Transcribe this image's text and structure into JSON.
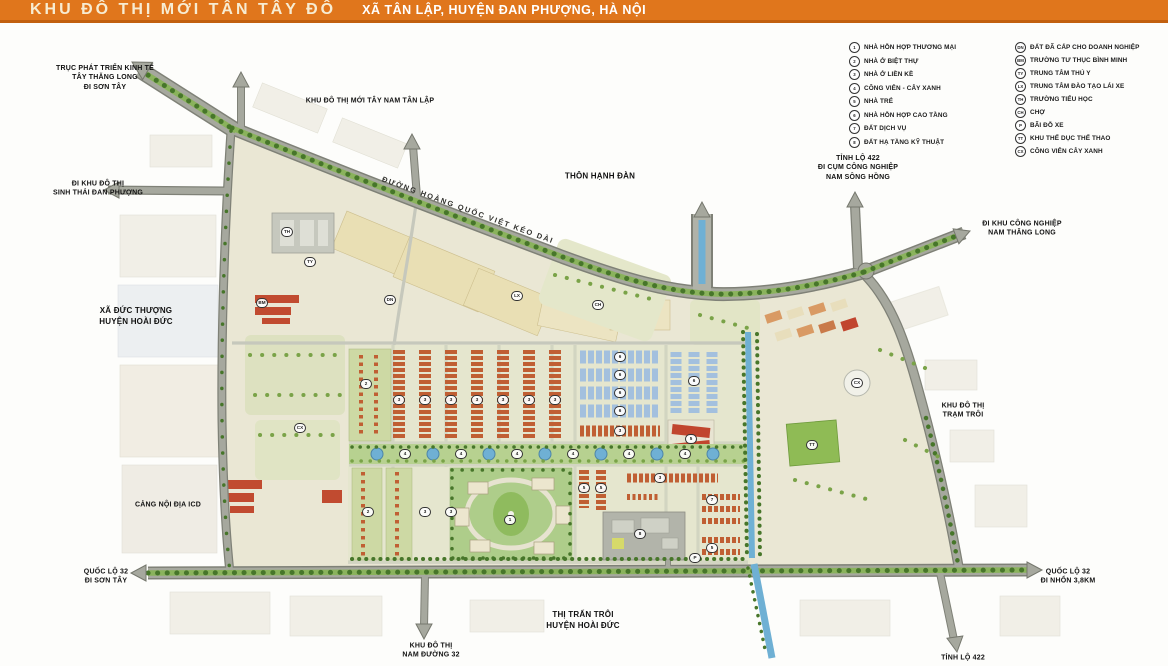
{
  "header": {
    "title": "KHU ĐÔ THỊ MỚI TÂN TÂY ĐÔ",
    "subtitle": "XÃ TÂN LẬP, HUYỆN ĐAN PHƯỢNG, HÀ NỘI"
  },
  "legend": {
    "numbered": [
      {
        "code": "1",
        "label": "NHÀ HỖN HỢP THƯƠNG MẠI"
      },
      {
        "code": "2",
        "label": "NHÀ Ở BIỆT THỰ"
      },
      {
        "code": "3",
        "label": "NHÀ Ở LIỀN KỀ"
      },
      {
        "code": "4",
        "label": "CÔNG VIÊN - CÂY XANH"
      },
      {
        "code": "5",
        "label": "NHÀ TRẺ"
      },
      {
        "code": "6",
        "label": "NHÀ HỖN HỢP CAO TẦNG"
      },
      {
        "code": "7",
        "label": "ĐẤT DỊCH VỤ"
      },
      {
        "code": "8",
        "label": "ĐẤT HẠ TẦNG KỸ THUẬT"
      }
    ],
    "lettered": [
      {
        "code": "DN",
        "label": "ĐẤT ĐÃ CẤP CHO DOANH NGHIỆP"
      },
      {
        "code": "BM",
        "label": "TRƯỜNG TƯ THỤC BÌNH MINH"
      },
      {
        "code": "TY",
        "label": "TRUNG TÂM THÚ Y"
      },
      {
        "code": "LX",
        "label": "TRUNG TÂM ĐÀO TẠO LÁI XE"
      },
      {
        "code": "TH",
        "label": "TRƯỜNG TIỂU HỌC"
      },
      {
        "code": "CH",
        "label": "CHỢ"
      },
      {
        "code": "P",
        "label": "BÃI ĐỖ XE"
      },
      {
        "code": "TT",
        "label": "KHU THỂ DỤC THỂ THAO"
      },
      {
        "code": "CX",
        "label": "CÔNG VIÊN CÂY XANH"
      }
    ]
  },
  "map_labels": {
    "economic_axis": "TRỤC PHÁT TRIỂN KINH TẾ\nTÂY THĂNG LONG\nĐI SƠN TÂY",
    "tay_nam_tan_lap": "KHU ĐÔ THỊ MỚI TÂY NAM TÂN LẬP",
    "sinh_thai_dan_phuong": "ĐI KHU ĐÔ THỊ\nSINH THÁI ĐAN PHƯỢNG",
    "thon_hanh_dan": "THÔN HẠNH ĐÀN",
    "hoang_quoc_viet": "ĐƯỜNG HOÀNG QUỐC VIỆT KÉO DÀI",
    "tl422_north": "TỈNH LỘ 422\nĐI CỤM CÔNG NGHIỆP\nNAM SÔNG HỒNG",
    "nam_thang_long": "ĐI KHU CÔNG NGHIỆP\nNAM THĂNG LONG",
    "xa_duc_thuong": "XÃ ĐỨC THƯỢNG\nHUYỆN HOÀI ĐỨC",
    "tram_troi": "KHU ĐÔ THỊ\nTRẠM TRÔI",
    "cang_icd": "CẢNG NỘI ĐỊA ICD",
    "ql32_west": "QUỐC LỘ 32\nĐI SƠN TÂY",
    "ql32_east": "QUỐC LỘ 32\nĐI NHỔN 3,8KM",
    "thi_tran_troi": "THỊ TRẤN TRÔI\nHUYỆN HOÀI ĐỨC",
    "nam_duong_32": "KHU ĐÔ THỊ\nNAM ĐƯỜNG 32",
    "tl422_south": "TỈNH LỘ 422"
  },
  "markers": [
    {
      "code": "2",
      "x": 366,
      "y": 384
    },
    {
      "code": "3",
      "x": 399,
      "y": 400
    },
    {
      "code": "3",
      "x": 425,
      "y": 400
    },
    {
      "code": "3",
      "x": 451,
      "y": 400
    },
    {
      "code": "3",
      "x": 477,
      "y": 400
    },
    {
      "code": "3",
      "x": 503,
      "y": 400
    },
    {
      "code": "3",
      "x": 529,
      "y": 400
    },
    {
      "code": "3",
      "x": 555,
      "y": 400
    },
    {
      "code": "6",
      "x": 620,
      "y": 357
    },
    {
      "code": "6",
      "x": 620,
      "y": 375
    },
    {
      "code": "6",
      "x": 620,
      "y": 393
    },
    {
      "code": "6",
      "x": 620,
      "y": 411
    },
    {
      "code": "6",
      "x": 694,
      "y": 381
    },
    {
      "code": "3",
      "x": 620,
      "y": 431
    },
    {
      "code": "5",
      "x": 691,
      "y": 439
    },
    {
      "code": "4",
      "x": 405,
      "y": 454
    },
    {
      "code": "4",
      "x": 461,
      "y": 454
    },
    {
      "code": "4",
      "x": 517,
      "y": 454
    },
    {
      "code": "4",
      "x": 573,
      "y": 454
    },
    {
      "code": "4",
      "x": 629,
      "y": 454
    },
    {
      "code": "4",
      "x": 685,
      "y": 454
    },
    {
      "code": "2",
      "x": 368,
      "y": 512
    },
    {
      "code": "3",
      "x": 425,
      "y": 512
    },
    {
      "code": "3",
      "x": 451,
      "y": 512
    },
    {
      "code": "1",
      "x": 510,
      "y": 520
    },
    {
      "code": "5",
      "x": 584,
      "y": 488
    },
    {
      "code": "5",
      "x": 601,
      "y": 488
    },
    {
      "code": "3",
      "x": 660,
      "y": 478
    },
    {
      "code": "8",
      "x": 640,
      "y": 534
    },
    {
      "code": "7",
      "x": 712,
      "y": 500
    },
    {
      "code": "5",
      "x": 712,
      "y": 548
    },
    {
      "code": "TH",
      "x": 287,
      "y": 232
    },
    {
      "code": "BM",
      "x": 262,
      "y": 303
    },
    {
      "code": "TY",
      "x": 310,
      "y": 262
    },
    {
      "code": "DN",
      "x": 390,
      "y": 300
    },
    {
      "code": "LX",
      "x": 517,
      "y": 296
    },
    {
      "code": "CH",
      "x": 598,
      "y": 305
    },
    {
      "code": "CX",
      "x": 300,
      "y": 428
    },
    {
      "code": "CX",
      "x": 857,
      "y": 383
    },
    {
      "code": "TT",
      "x": 812,
      "y": 445
    },
    {
      "code": "P",
      "x": 695,
      "y": 558
    }
  ],
  "colors": {
    "header-bg": "#e0761c",
    "road": "#a6a89e",
    "road-edge": "#7f8177",
    "site": "#eae7d4",
    "tree": "#8ab35c",
    "tree-dark": "#47762a",
    "water": "#6fb0d4",
    "rowhouse": "#c05f33",
    "highrise": "#a3c0de",
    "park": "#aecd8a"
  }
}
